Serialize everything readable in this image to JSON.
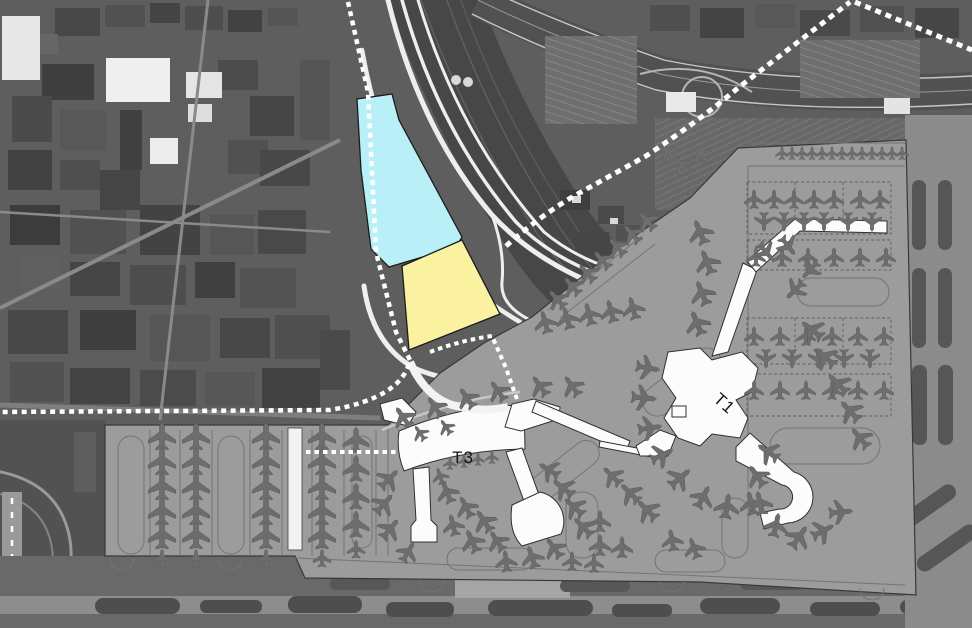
{
  "map": {
    "labels": {
      "terminal_1": "T1",
      "terminal_3": "T3"
    },
    "colors": {
      "parcel_north_fill": "#b9f0f7",
      "parcel_south_fill": "#faf2a1",
      "apron_fill": "#9c9c9c",
      "terminal_fill": "#fcfcfc",
      "aircraft_fill": "#6d6d6d",
      "transit_line": "#ffffff"
    },
    "aircraft_stands": [
      [
        162,
        436,
        0,
        1.15
      ],
      [
        162,
        461,
        0,
        1.15
      ],
      [
        162,
        486,
        0,
        1.15
      ],
      [
        162,
        511,
        0,
        1.15
      ],
      [
        162,
        535,
        0,
        1.15
      ],
      [
        162,
        558,
        0,
        0.75
      ],
      [
        196,
        436,
        0,
        1.15
      ],
      [
        196,
        461,
        0,
        1.15
      ],
      [
        196,
        486,
        0,
        1.15
      ],
      [
        196,
        511,
        0,
        1.15
      ],
      [
        196,
        535,
        0,
        1.15
      ],
      [
        196,
        558,
        0,
        0.75
      ],
      [
        266,
        436,
        0,
        1.15
      ],
      [
        266,
        461,
        0,
        1.15
      ],
      [
        266,
        486,
        0,
        1.15
      ],
      [
        266,
        511,
        0,
        1.15
      ],
      [
        266,
        535,
        0,
        1.15
      ],
      [
        266,
        558,
        0,
        0.75
      ],
      [
        322,
        436,
        0,
        1.15
      ],
      [
        322,
        461,
        0,
        1.15
      ],
      [
        322,
        486,
        0,
        1.15
      ],
      [
        322,
        511,
        0,
        1.15
      ],
      [
        322,
        535,
        0,
        1.15
      ],
      [
        322,
        558,
        0,
        0.75
      ],
      [
        356,
        440,
        0,
        1.1
      ],
      [
        356,
        468,
        0,
        1.1
      ],
      [
        356,
        496,
        0,
        1.1
      ],
      [
        356,
        524,
        0,
        1.1
      ],
      [
        356,
        549,
        0,
        0.75
      ],
      [
        545,
        322,
        -15,
        0.95
      ],
      [
        567,
        318,
        -15,
        0.95
      ],
      [
        589,
        314,
        -15,
        0.95
      ],
      [
        611,
        311,
        -15,
        0.95
      ],
      [
        633,
        308,
        -15,
        0.95
      ],
      [
        403,
        417,
        -35,
        0.95
      ],
      [
        435,
        407,
        -35,
        0.95
      ],
      [
        467,
        398,
        -35,
        0.95
      ],
      [
        498,
        391,
        -35,
        0.95
      ],
      [
        540,
        386,
        -35,
        0.95
      ],
      [
        572,
        386,
        -35,
        0.95
      ],
      [
        420,
        433,
        -35,
        0.7
      ],
      [
        446,
        427,
        -35,
        0.7
      ],
      [
        557,
        299,
        -42,
        0.9
      ],
      [
        572,
        286,
        -42,
        0.9
      ],
      [
        587,
        273,
        -42,
        0.9
      ],
      [
        602,
        260,
        -42,
        0.9
      ],
      [
        617,
        247,
        -42,
        0.9
      ],
      [
        632,
        234,
        -42,
        0.9
      ],
      [
        647,
        221,
        -42,
        0.9
      ],
      [
        700,
        232,
        -22,
        1.05
      ],
      [
        707,
        262,
        -22,
        1.05
      ],
      [
        702,
        293,
        -22,
        1.05
      ],
      [
        697,
        323,
        -22,
        1.05
      ],
      [
        668,
        152,
        -40,
        0.8
      ],
      [
        682,
        165,
        -40,
        0.8
      ],
      [
        700,
        154,
        -40,
        0.8
      ],
      [
        782,
        153,
        0,
        0.55
      ],
      [
        792,
        153,
        0,
        0.55
      ],
      [
        802,
        153,
        0,
        0.55
      ],
      [
        812,
        153,
        0,
        0.55
      ],
      [
        822,
        153,
        0,
        0.55
      ],
      [
        832,
        153,
        0,
        0.55
      ],
      [
        842,
        153,
        0,
        0.55
      ],
      [
        852,
        153,
        0,
        0.55
      ],
      [
        862,
        153,
        0,
        0.55
      ],
      [
        872,
        153,
        0,
        0.55
      ],
      [
        882,
        153,
        0,
        0.55
      ],
      [
        892,
        153,
        0,
        0.55
      ],
      [
        902,
        153,
        0,
        0.55
      ],
      [
        754,
        199,
        0,
        0.8
      ],
      [
        774,
        199,
        0,
        0.8
      ],
      [
        794,
        199,
        0,
        0.8
      ],
      [
        814,
        199,
        0,
        0.8
      ],
      [
        834,
        199,
        0,
        0.8
      ],
      [
        860,
        199,
        0,
        0.8
      ],
      [
        880,
        199,
        0,
        0.8
      ],
      [
        764,
        222,
        180,
        0.8
      ],
      [
        784,
        222,
        180,
        0.8
      ],
      [
        804,
        222,
        180,
        0.8
      ],
      [
        824,
        222,
        180,
        0.8
      ],
      [
        848,
        222,
        180,
        0.8
      ],
      [
        872,
        222,
        180,
        0.8
      ],
      [
        756,
        257,
        0,
        0.8
      ],
      [
        782,
        257,
        0,
        0.8
      ],
      [
        808,
        257,
        0,
        0.8
      ],
      [
        834,
        257,
        0,
        0.8
      ],
      [
        860,
        257,
        0,
        0.8
      ],
      [
        886,
        257,
        0,
        0.8
      ],
      [
        754,
        336,
        0,
        0.8
      ],
      [
        780,
        336,
        0,
        0.8
      ],
      [
        806,
        336,
        0,
        0.8
      ],
      [
        832,
        336,
        0,
        0.8
      ],
      [
        858,
        336,
        0,
        0.8
      ],
      [
        884,
        336,
        0,
        0.8
      ],
      [
        766,
        359,
        180,
        0.8
      ],
      [
        792,
        359,
        180,
        0.8
      ],
      [
        818,
        359,
        180,
        0.8
      ],
      [
        844,
        359,
        180,
        0.8
      ],
      [
        870,
        359,
        180,
        0.8
      ],
      [
        754,
        390,
        0,
        0.8
      ],
      [
        780,
        390,
        0,
        0.8
      ],
      [
        806,
        390,
        0,
        0.8
      ],
      [
        832,
        390,
        0,
        0.8
      ],
      [
        858,
        390,
        0,
        0.8
      ],
      [
        884,
        390,
        0,
        0.8
      ],
      [
        648,
        368,
        100,
        1
      ],
      [
        644,
        398,
        95,
        1.05
      ],
      [
        650,
        428,
        82,
        1
      ],
      [
        662,
        455,
        65,
        1
      ],
      [
        680,
        478,
        50,
        1.05
      ],
      [
        703,
        497,
        28,
        1
      ],
      [
        727,
        506,
        8,
        1.05
      ],
      [
        751,
        503,
        -12,
        1
      ],
      [
        768,
        452,
        -55,
        1
      ],
      [
        757,
        476,
        -35,
        1
      ],
      [
        760,
        503,
        -12,
        1
      ],
      [
        776,
        525,
        12,
        1
      ],
      [
        799,
        537,
        35,
        1.05
      ],
      [
        823,
        531,
        62,
        1
      ],
      [
        841,
        512,
        85,
        1
      ],
      [
        812,
        330,
        -52,
        1.05
      ],
      [
        825,
        357,
        -48,
        1.05
      ],
      [
        838,
        384,
        -45,
        1.05
      ],
      [
        850,
        411,
        -43,
        1.05
      ],
      [
        860,
        438,
        -40,
        1
      ],
      [
        766,
        252,
        140,
        0.9
      ],
      [
        788,
        246,
        142,
        0.9
      ],
      [
        795,
        290,
        -135,
        0.95
      ],
      [
        810,
        270,
        -137,
        0.9
      ],
      [
        389,
        479,
        45,
        1
      ],
      [
        384,
        504,
        42,
        1
      ],
      [
        390,
        529,
        40,
        1
      ],
      [
        447,
        492,
        -22,
        0.95
      ],
      [
        466,
        507,
        -28,
        0.95
      ],
      [
        484,
        521,
        -33,
        1
      ],
      [
        453,
        525,
        -14,
        0.9
      ],
      [
        472,
        541,
        -24,
        1
      ],
      [
        497,
        541,
        -33,
        0.95
      ],
      [
        440,
        476,
        -18,
        0.7
      ],
      [
        549,
        470,
        -58,
        0.95
      ],
      [
        563,
        488,
        -52,
        1
      ],
      [
        574,
        507,
        -48,
        1
      ],
      [
        583,
        527,
        -44,
        1
      ],
      [
        532,
        557,
        -18,
        0.95
      ],
      [
        554,
        548,
        -36,
        0.95
      ],
      [
        506,
        561,
        -6,
        0.9
      ],
      [
        450,
        463,
        0,
        0.55
      ],
      [
        464,
        461,
        0,
        0.55
      ],
      [
        478,
        459,
        0,
        0.55
      ],
      [
        492,
        457,
        0,
        0.55
      ],
      [
        408,
        552,
        30,
        0.9
      ],
      [
        612,
        476,
        -45,
        0.95
      ],
      [
        630,
        493,
        -45,
        1
      ],
      [
        647,
        510,
        -45,
        1.05
      ],
      [
        600,
        521,
        0,
        0.9
      ],
      [
        600,
        545,
        0,
        0.9
      ],
      [
        622,
        547,
        0,
        0.9
      ],
      [
        572,
        561,
        0,
        0.8
      ],
      [
        594,
        563,
        0,
        0.8
      ],
      [
        672,
        540,
        -10,
        0.9
      ],
      [
        694,
        548,
        -20,
        0.9
      ]
    ]
  }
}
